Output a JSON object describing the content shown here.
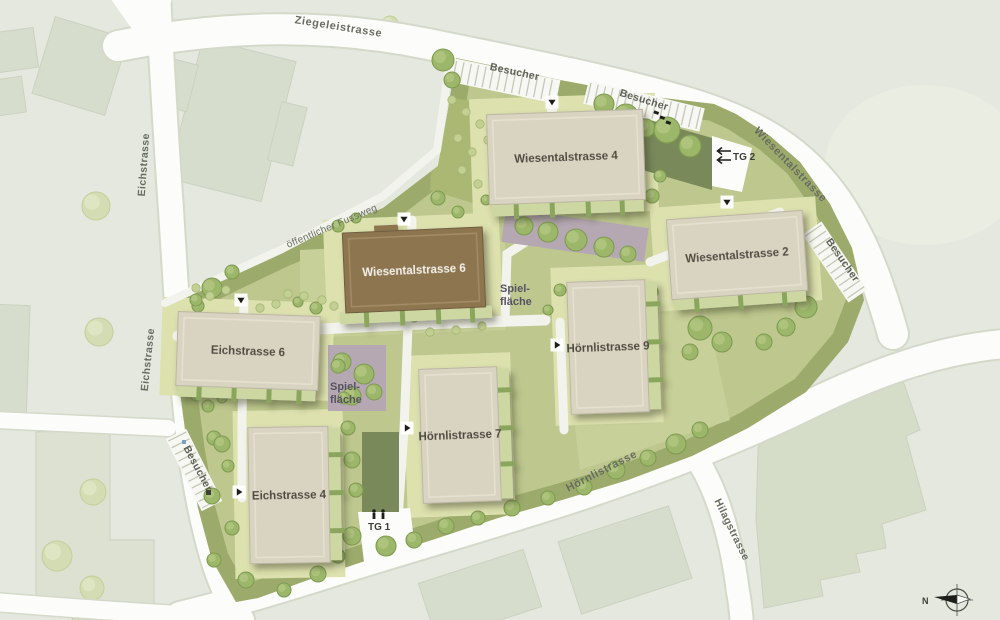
{
  "plan": {
    "streets": {
      "ziegeleistrasse": "Ziegeleistrasse",
      "wiesentalstrasse": "Wiesentalstrasse",
      "eichstrasse": "Eichstrasse",
      "hoernlistrasse": "Hörnlistrasse",
      "hilagstrasse": "Hilagstrasse"
    },
    "buildings": {
      "wiesentalstrasse_4": "Wiesentalstrasse 4",
      "wiesentalstrasse_2": "Wiesentalstrasse 2",
      "wiesentalstrasse_6": "Wiesentalstrasse 6",
      "eichstrasse_6": "Eichstrasse 6",
      "eichstrasse_4": "Eichstrasse 4",
      "hoernlistrasse_7": "Hörnlistrasse 7",
      "hoernlistrasse_9": "Hörnlistrasse 9"
    },
    "labels": {
      "besucher": "Besucher",
      "tg_1": "TG 1",
      "tg_2": "TG 2",
      "fussweg": "öffentlicher Fussweg",
      "spiel_line1": "Spiel-",
      "spiel_line2": "fläche",
      "north": "N"
    },
    "colors": {
      "background": "#e4e8de",
      "road": "#fcfdfa",
      "site_green": "#bdc78e",
      "border_green": "#9cab6c",
      "lawn": "#dce1ae",
      "building_beige": "#d9d3c1",
      "building_brown": "#8c7550",
      "ramp_green": "#79895a",
      "play_mauve": "#b5a8b3",
      "tree_green": "#9cb76a"
    }
  }
}
